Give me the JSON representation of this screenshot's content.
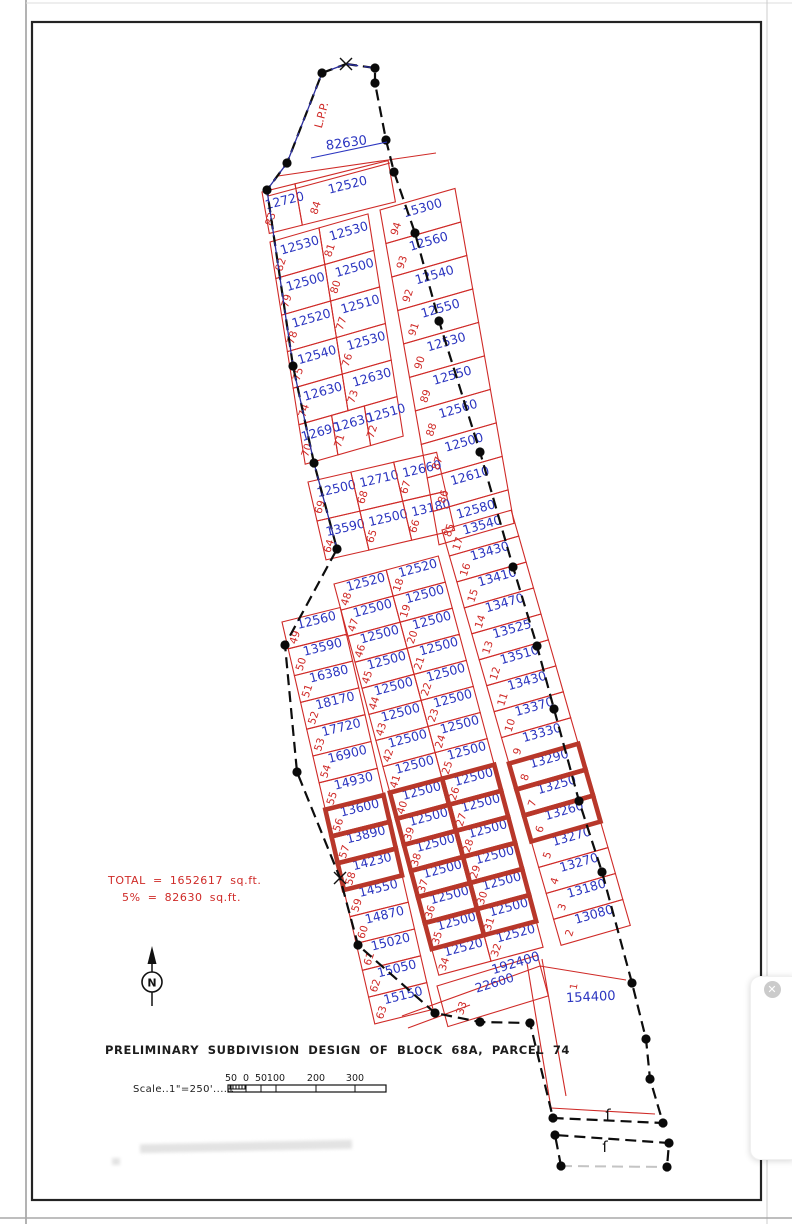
{
  "annotations": {
    "title": "PRELIMINARY SUBDIVISION DESIGN OF BLOCK 68A, PARCEL 74",
    "scale_label": "Scale..1\"=250'......",
    "scale_ticks": [
      "50",
      "0",
      "50",
      "100",
      "200",
      "300"
    ],
    "total_line1": "TOTAL = 1652617 sq.ft.",
    "total_line2": "5% = 82630 sq.ft.",
    "lpp": "L.P.P.",
    "top_area": "82630",
    "road_area": "192400",
    "remainder_area": "154400",
    "remainder_lot": "1",
    "north_letter": "N",
    "match_mark": "ſ",
    "close_symbol": "✕"
  },
  "colors": {
    "red": "#cf2a27",
    "blue": "#2b35c0",
    "highlight": "#b8372a",
    "dark": "#111111",
    "navy": "#2a2e9e"
  },
  "blocks": [
    {
      "id": "top-strip",
      "origin": [
        262,
        192
      ],
      "row_angle": -14,
      "col_tilt": 10,
      "rows": [
        {
          "h": 42,
          "cells": [
            {
              "w": 34,
              "n": "83",
              "a": "12720"
            },
            {
              "w": 96,
              "n": "84",
              "a": "12520"
            }
          ]
        }
      ]
    },
    {
      "id": "block-a",
      "origin": [
        270,
        242
      ],
      "row_angle": -16,
      "col_tilt": 9,
      "rows": [
        {
          "h": 37,
          "cells": [
            {
              "w": 51,
              "n": "82",
              "a": "12530"
            },
            {
              "w": 51,
              "n": "81",
              "a": "12530"
            }
          ]
        },
        {
          "h": 37,
          "cells": [
            {
              "w": 51,
              "n": "79",
              "a": "12500"
            },
            {
              "w": 51,
              "n": "80",
              "a": "12500"
            }
          ]
        },
        {
          "h": 37,
          "cells": [
            {
              "w": 51,
              "n": "78",
              "a": "12520"
            },
            {
              "w": 51,
              "n": "77",
              "a": "12510"
            }
          ]
        },
        {
          "h": 37,
          "cells": [
            {
              "w": 51,
              "n": "75",
              "a": "12540"
            },
            {
              "w": 51,
              "n": "76",
              "a": "12530"
            }
          ]
        },
        {
          "h": 37,
          "cells": [
            {
              "w": 51,
              "n": "74",
              "a": "12630"
            },
            {
              "w": 51,
              "n": "73",
              "a": "12630"
            }
          ]
        },
        {
          "h": 40,
          "cells": [
            {
              "w": 34,
              "n": "70",
              "a": "12690"
            },
            {
              "w": 34,
              "n": "71",
              "a": "12630"
            },
            {
              "w": 34,
              "n": "72",
              "a": "12510"
            }
          ]
        }
      ]
    },
    {
      "id": "block-b",
      "origin": [
        308,
        482
      ],
      "row_angle": -13,
      "col_tilt": 13,
      "rows": [
        {
          "h": 40,
          "cells": [
            {
              "w": 44,
              "n": "69",
              "a": "12500"
            },
            {
              "w": 44,
              "n": "68",
              "a": "12710"
            },
            {
              "w": 44,
              "n": "67",
              "a": "12660"
            }
          ]
        },
        {
          "h": 40,
          "cells": [
            {
              "w": 44,
              "n": "64",
              "a": "13590"
            },
            {
              "w": 44,
              "n": "65",
              "a": "12500"
            },
            {
              "w": 44,
              "n": "66",
              "a": "13180"
            }
          ]
        }
      ]
    },
    {
      "id": "right-col-upper",
      "origin": [
        380,
        210
      ],
      "row_angle": -16,
      "col_tilt": 10,
      "rows": [
        {
          "h": 34,
          "cells": [
            {
              "w": 78,
              "n": "94",
              "a": "15300"
            }
          ]
        },
        {
          "h": 34,
          "cells": [
            {
              "w": 78,
              "n": "93",
              "a": "12560"
            }
          ]
        },
        {
          "h": 34,
          "cells": [
            {
              "w": 78,
              "n": "92",
              "a": "12540"
            }
          ]
        },
        {
          "h": 34,
          "cells": [
            {
              "w": 78,
              "n": "91",
              "a": "12550"
            }
          ]
        },
        {
          "h": 34,
          "cells": [
            {
              "w": 78,
              "n": "90",
              "a": "12530"
            }
          ]
        },
        {
          "h": 34,
          "cells": [
            {
              "w": 78,
              "n": "89",
              "a": "12550"
            }
          ]
        },
        {
          "h": 34,
          "cells": [
            {
              "w": 78,
              "n": "88",
              "a": "12560"
            }
          ]
        },
        {
          "h": 34,
          "cells": [
            {
              "w": 78,
              "n": "87",
              "a": "12500"
            }
          ]
        },
        {
          "h": 34,
          "cells": [
            {
              "w": 78,
              "n": "86",
              "a": "12610"
            }
          ]
        },
        {
          "h": 34,
          "cells": [
            {
              "w": 78,
              "n": "85",
              "a": "12580"
            }
          ]
        }
      ]
    },
    {
      "id": "right-col-lower",
      "origin": [
        442,
        530
      ],
      "row_angle": -16,
      "col_tilt": 16,
      "rows": [
        {
          "h": 27,
          "cells": [
            {
              "w": 72,
              "n": "17",
              "a": "13540"
            }
          ]
        },
        {
          "h": 27,
          "cells": [
            {
              "w": 72,
              "n": "16",
              "a": "13430"
            }
          ]
        },
        {
          "h": 27,
          "cells": [
            {
              "w": 72,
              "n": "15",
              "a": "13410"
            }
          ]
        },
        {
          "h": 27,
          "cells": [
            {
              "w": 72,
              "n": "14",
              "a": "13470"
            }
          ]
        },
        {
          "h": 27,
          "cells": [
            {
              "w": 72,
              "n": "13",
              "a": "13525"
            }
          ]
        },
        {
          "h": 27,
          "cells": [
            {
              "w": 72,
              "n": "12",
              "a": "13510"
            }
          ]
        },
        {
          "h": 27,
          "cells": [
            {
              "w": 72,
              "n": "11",
              "a": "13430"
            }
          ]
        },
        {
          "h": 27,
          "cells": [
            {
              "w": 72,
              "n": "10",
              "a": "13370"
            }
          ]
        },
        {
          "h": 27,
          "cells": [
            {
              "w": 72,
              "n": "9",
              "a": "13330"
            }
          ]
        },
        {
          "h": 27,
          "cells": [
            {
              "w": 72,
              "n": "8",
              "a": "13290",
              "hl": true
            }
          ]
        },
        {
          "h": 27,
          "cells": [
            {
              "w": 72,
              "n": "7",
              "a": "13250",
              "hl": true
            }
          ]
        },
        {
          "h": 27,
          "cells": [
            {
              "w": 72,
              "n": "6",
              "a": "13260",
              "hl": true
            }
          ]
        },
        {
          "h": 27,
          "cells": [
            {
              "w": 72,
              "n": "5",
              "a": "13270"
            }
          ]
        },
        {
          "h": 27,
          "cells": [
            {
              "w": 72,
              "n": "4",
              "a": "13270"
            }
          ]
        },
        {
          "h": 27,
          "cells": [
            {
              "w": 72,
              "n": "3",
              "a": "13180"
            }
          ]
        },
        {
          "h": 27,
          "cells": [
            {
              "w": 72,
              "n": "2",
              "a": "13080"
            }
          ]
        }
      ]
    },
    {
      "id": "mid-left-col",
      "origin": [
        282,
        622
      ],
      "row_angle": -14,
      "col_tilt": 13,
      "rows": [
        {
          "h": 27.5,
          "cells": [
            {
              "w": 60,
              "n": "49",
              "a": "12560"
            }
          ]
        },
        {
          "h": 27.5,
          "cells": [
            {
              "w": 60,
              "n": "50",
              "a": "13590"
            }
          ]
        },
        {
          "h": 27.5,
          "cells": [
            {
              "w": 60,
              "n": "51",
              "a": "16380"
            }
          ]
        },
        {
          "h": 27.5,
          "cells": [
            {
              "w": 60,
              "n": "52",
              "a": "18170"
            }
          ]
        },
        {
          "h": 27.5,
          "cells": [
            {
              "w": 60,
              "n": "53",
              "a": "17720"
            }
          ]
        },
        {
          "h": 27.5,
          "cells": [
            {
              "w": 60,
              "n": "54",
              "a": "16900"
            }
          ]
        },
        {
          "h": 27.5,
          "cells": [
            {
              "w": 60,
              "n": "55",
              "a": "14930"
            }
          ]
        },
        {
          "h": 27.5,
          "cells": [
            {
              "w": 60,
              "n": "56",
              "a": "13600",
              "hl": true
            }
          ]
        },
        {
          "h": 27.5,
          "cells": [
            {
              "w": 60,
              "n": "57",
              "a": "13890",
              "hl": true
            }
          ]
        },
        {
          "h": 27.5,
          "cells": [
            {
              "w": 60,
              "n": "58",
              "a": "14230",
              "hl": true
            }
          ]
        },
        {
          "h": 27.5,
          "cells": [
            {
              "w": 60,
              "n": "59",
              "a": "14550"
            }
          ]
        },
        {
          "h": 27.5,
          "cells": [
            {
              "w": 60,
              "n": "60",
              "a": "14870"
            }
          ]
        },
        {
          "h": 27.5,
          "cells": [
            {
              "w": 60,
              "n": "61",
              "a": "15020"
            }
          ]
        },
        {
          "h": 27.5,
          "cells": [
            {
              "w": 60,
              "n": "62",
              "a": "15050"
            }
          ]
        },
        {
          "h": 27.5,
          "cells": [
            {
              "w": 60,
              "n": "63",
              "a": "15150"
            }
          ]
        }
      ]
    },
    {
      "id": "mid-double",
      "origin": [
        334,
        584
      ],
      "row_angle": -15,
      "col_tilt": 15,
      "rows": [
        {
          "h": 27,
          "cells": [
            {
              "w": 54,
              "n": "48",
              "a": "12520"
            },
            {
              "w": 54,
              "n": "18",
              "a": "12520"
            }
          ]
        },
        {
          "h": 27,
          "cells": [
            {
              "w": 54,
              "n": "47",
              "a": "12500"
            },
            {
              "w": 54,
              "n": "19",
              "a": "12500"
            }
          ]
        },
        {
          "h": 27,
          "cells": [
            {
              "w": 54,
              "n": "46",
              "a": "12500"
            },
            {
              "w": 54,
              "n": "20",
              "a": "12500"
            }
          ]
        },
        {
          "h": 27,
          "cells": [
            {
              "w": 54,
              "n": "45",
              "a": "12500"
            },
            {
              "w": 54,
              "n": "21",
              "a": "12500"
            }
          ]
        },
        {
          "h": 27,
          "cells": [
            {
              "w": 54,
              "n": "44",
              "a": "12500"
            },
            {
              "w": 54,
              "n": "22",
              "a": "12500"
            }
          ]
        },
        {
          "h": 27,
          "cells": [
            {
              "w": 54,
              "n": "43",
              "a": "12500"
            },
            {
              "w": 54,
              "n": "23",
              "a": "12500"
            }
          ]
        },
        {
          "h": 27,
          "cells": [
            {
              "w": 54,
              "n": "42",
              "a": "12500"
            },
            {
              "w": 54,
              "n": "24",
              "a": "12500"
            }
          ]
        },
        {
          "h": 27,
          "cells": [
            {
              "w": 54,
              "n": "41",
              "a": "12500"
            },
            {
              "w": 54,
              "n": "25",
              "a": "12500"
            }
          ]
        },
        {
          "h": 27,
          "cells": [
            {
              "w": 54,
              "n": "40",
              "a": "12500",
              "hl": true
            },
            {
              "w": 54,
              "n": "26",
              "a": "12500",
              "hl": true
            }
          ]
        },
        {
          "h": 27,
          "cells": [
            {
              "w": 54,
              "n": "39",
              "a": "12500",
              "hl": true
            },
            {
              "w": 54,
              "n": "27",
              "a": "12500",
              "hl": true
            }
          ]
        },
        {
          "h": 27,
          "cells": [
            {
              "w": 54,
              "n": "38",
              "a": "12500",
              "hl": true
            },
            {
              "w": 54,
              "n": "28",
              "a": "12500",
              "hl": true
            }
          ]
        },
        {
          "h": 27,
          "cells": [
            {
              "w": 54,
              "n": "37",
              "a": "12500",
              "hl": true
            },
            {
              "w": 54,
              "n": "29",
              "a": "12500",
              "hl": true
            }
          ]
        },
        {
          "h": 27,
          "cells": [
            {
              "w": 54,
              "n": "36",
              "a": "12500",
              "hl": true
            },
            {
              "w": 54,
              "n": "30",
              "a": "12500",
              "hl": true
            }
          ]
        },
        {
          "h": 27,
          "cells": [
            {
              "w": 54,
              "n": "35",
              "a": "12500",
              "hl": true
            },
            {
              "w": 54,
              "n": "31",
              "a": "12500",
              "hl": true
            }
          ]
        },
        {
          "h": 27,
          "cells": [
            {
              "w": 54,
              "n": "34",
              "a": "12520"
            },
            {
              "w": 54,
              "n": "32",
              "a": "12520"
            }
          ]
        }
      ]
    },
    {
      "id": "lot-33",
      "origin": [
        437,
        986
      ],
      "row_angle": -17,
      "col_tilt": 15,
      "rows": [
        {
          "h": 42,
          "cells": [
            {
              "w": 105,
              "n": "33",
              "a": "22600"
            }
          ]
        }
      ]
    }
  ]
}
